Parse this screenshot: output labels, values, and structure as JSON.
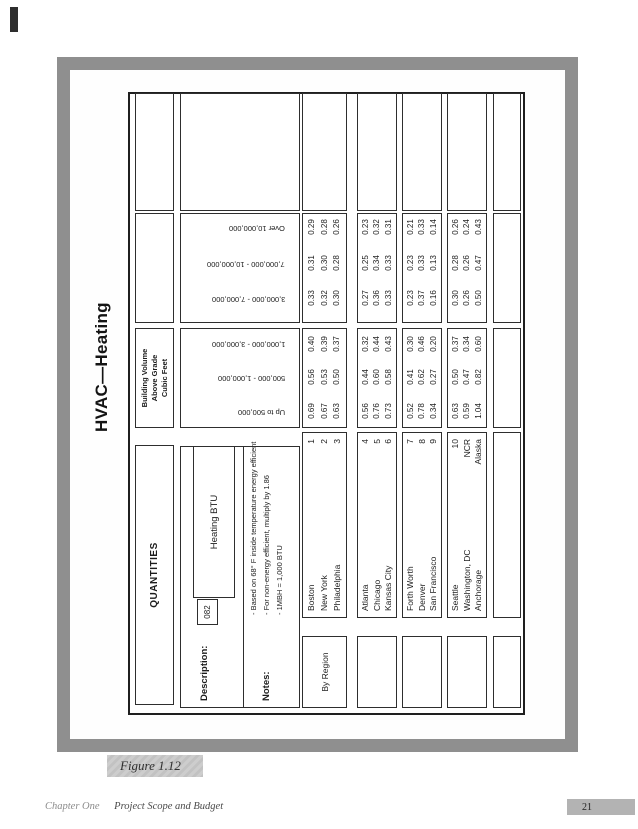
{
  "page": {
    "title": "HVAC—Heating",
    "figure_caption": "Figure 1.12",
    "footer_chapter": "Chapter One",
    "footer_section": "Project Scope and Budget",
    "page_number": "21",
    "colors": {
      "frame": "#8f8f8f",
      "caption_bg": "#c8c8c8",
      "badge_bg": "#b3b3b3"
    }
  },
  "form": {
    "quantities_label": "QUANTITIES",
    "description_label": "Description:",
    "description_code": "082",
    "description_item": "Heating BTU",
    "notes_label": "Notes:",
    "notes": [
      "- Based on 68° F inside temperature energy efficient",
      "- For non-energy efficient, multiply by 1.86",
      "- 1MBH = 1,000 BTU"
    ],
    "by_region_label": "By Region",
    "volume_header": [
      "Building Volume",
      "Above Grade",
      "Cubic Feet"
    ],
    "volume_columns": [
      "Up to 500,000",
      "500,000 - 1,000,000",
      "1,000,000 - 3,000,000",
      "3,000,000 - 7,000,000",
      "7,000,000 - 10,000,000",
      "Over 10,000,000"
    ],
    "groups": [
      {
        "rows": [
          {
            "city": "Boston",
            "code": "1",
            "values": [
              "0.69",
              "0.56",
              "0.40",
              "0.33",
              "0.31",
              "0.29"
            ]
          },
          {
            "city": "New York",
            "code": "2",
            "values": [
              "0.67",
              "0.53",
              "0.39",
              "0.32",
              "0.30",
              "0.28"
            ]
          },
          {
            "city": "Philadelphia",
            "code": "3",
            "values": [
              "0.63",
              "0.50",
              "0.37",
              "0.30",
              "0.28",
              "0.26"
            ]
          }
        ]
      },
      {
        "rows": [
          {
            "city": "Atlanta",
            "code": "4",
            "values": [
              "0.56",
              "0.44",
              "0.32",
              "0.27",
              "0.25",
              "0.23"
            ]
          },
          {
            "city": "Chicago",
            "code": "5",
            "values": [
              "0.76",
              "0.60",
              "0.44",
              "0.36",
              "0.34",
              "0.32"
            ]
          },
          {
            "city": "Kansas City",
            "code": "6",
            "values": [
              "0.73",
              "0.58",
              "0.43",
              "0.33",
              "0.33",
              "0.31"
            ]
          }
        ]
      },
      {
        "rows": [
          {
            "city": "Forth Worth",
            "code": "7",
            "values": [
              "0.52",
              "0.41",
              "0.30",
              "0.23",
              "0.23",
              "0.21"
            ]
          },
          {
            "city": "Denver",
            "code": "8",
            "values": [
              "0.78",
              "0.62",
              "0.46",
              "0.37",
              "0.33",
              "0.33"
            ]
          },
          {
            "city": "San Francisco",
            "code": "9",
            "values": [
              "0.34",
              "0.27",
              "0.20",
              "0.16",
              "0.13",
              "0.14"
            ]
          }
        ]
      },
      {
        "rows": [
          {
            "city": "Seattle",
            "code": "10",
            "values": [
              "0.63",
              "0.50",
              "0.37",
              "0.30",
              "0.28",
              "0.26"
            ]
          },
          {
            "city": "Washington, DC",
            "code": "NCR",
            "values": [
              "0.59",
              "0.47",
              "0.34",
              "0.26",
              "0.26",
              "0.24"
            ]
          },
          {
            "city": "Anchorage",
            "code": "Alaska",
            "values": [
              "1.04",
              "0.82",
              "0.60",
              "0.50",
              "0.47",
              "0.43"
            ]
          }
        ]
      }
    ]
  }
}
